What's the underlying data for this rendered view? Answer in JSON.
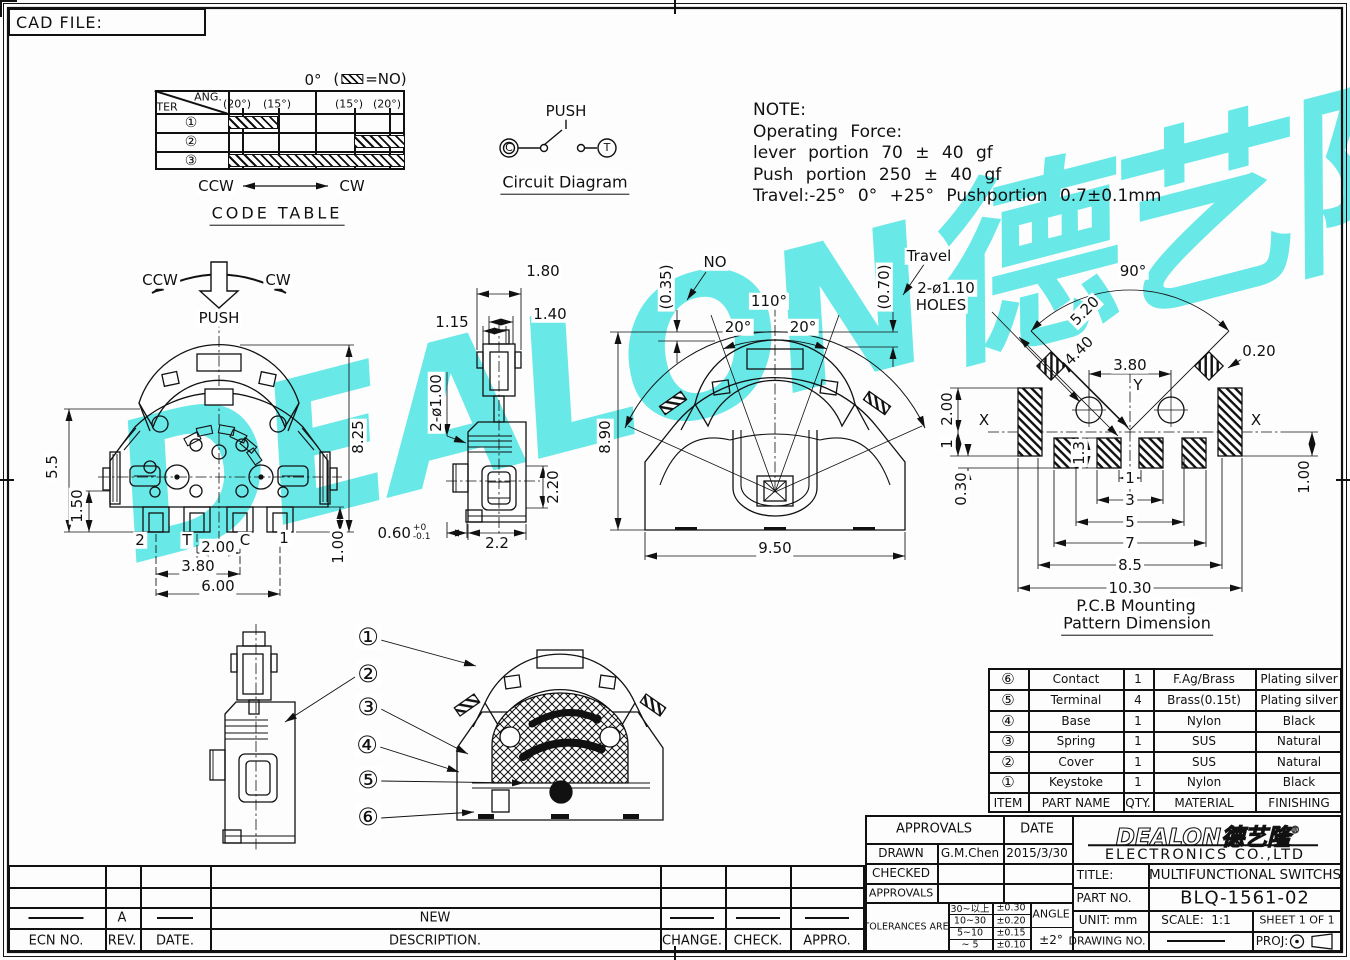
{
  "page": {
    "cad_file": "CAD FILE:"
  },
  "watermark": {
    "text": "DEALON德艺隆",
    "reg": "®",
    "color": "#45e4e4"
  },
  "code_table": {
    "title": "CODE TABLE",
    "ter": "TER",
    "ang": "ANG.",
    "zero": "0°",
    "legend_open": "(",
    "legend_close": "=NO)",
    "headers": [
      "(20°)",
      "(15°)",
      "(15°)",
      "(20°)"
    ],
    "rows": [
      "①",
      "②",
      "③"
    ],
    "ccw": "CCW",
    "cw": "CW"
  },
  "circuit": {
    "push": "PUSH",
    "c": "C",
    "t": "T",
    "title": "Circuit Diagram"
  },
  "note": {
    "l1": "NOTE:",
    "l2": "Operating Force:",
    "l3": "lever portion 70 ± 40 gf",
    "l4": "Push portion 250 ± 40 gf",
    "l5": "Travel:-25° 0° +25° Pushportion 0.7±0.1mm"
  },
  "front_view": {
    "ccw": "CCW",
    "cw": "CW",
    "push": "PUSH",
    "terminals": [
      "2",
      "T",
      "C",
      "1"
    ],
    "dims": {
      "d55": "5.5",
      "d150": "1.50",
      "d825": "8.25",
      "d100": "1.00",
      "d200": "2.00",
      "d380": "3.80",
      "d600": "6.00",
      "tol": "0.60",
      "tol_up": "+0",
      "tol_dn": "-0.1"
    }
  },
  "side_view": {
    "dims": {
      "d180": "1.80",
      "d115": "1.15",
      "d140": "1.40",
      "dphi": "2-ø1.00",
      "d220": "2.20",
      "d22": "2.2"
    }
  },
  "fan_view": {
    "no": "NO",
    "d035": "(0.35)",
    "d110": "110°",
    "d20l": "20°",
    "d20r": "20°",
    "travel": "Travel",
    "d070": "(0.70)",
    "d890": "8.90",
    "d950": "9.50"
  },
  "pcb_view": {
    "d90": "90°",
    "holes1": "2-ø1.10",
    "holes2": "HOLES",
    "d520": "5.20",
    "d440": "4.40",
    "d380": "3.80",
    "d020": "0.20",
    "d200": "2.00",
    "d1s": "1",
    "d030": "0.30",
    "d13": "1.3",
    "d100": "1.00",
    "x_left": "X",
    "x_right": "X",
    "y": "Y",
    "chain": [
      "1",
      "3",
      "5",
      "7",
      "8.5",
      "10.30"
    ],
    "caption1": "P.C.B Mounting",
    "caption2": "Pattern Dimension"
  },
  "exploded": {
    "balloons": [
      "①",
      "②",
      "③",
      "④",
      "⑤",
      "⑥"
    ]
  },
  "parts_table": {
    "headers": [
      "ITEM",
      "PART NAME",
      "QTY.",
      "MATERIAL",
      "FINISHING"
    ],
    "rows": [
      [
        "⑥",
        "Contact",
        "1",
        "F.Ag/Brass",
        "Plating silver"
      ],
      [
        "⑤",
        "Terminal",
        "4",
        "Brass(0.15t)",
        "Plating silver"
      ],
      [
        "④",
        "Base",
        "1",
        "Nylon",
        "Black"
      ],
      [
        "③",
        "Spring",
        "1",
        "SUS",
        "Natural"
      ],
      [
        "②",
        "Cover",
        "1",
        "SUS",
        "Natural"
      ],
      [
        "①",
        "Keystoke",
        "1",
        "Nylon",
        "Black"
      ]
    ]
  },
  "title_block": {
    "approvals": "APPROVALS",
    "date": "DATE",
    "drawn": "DRAWN",
    "drawn_by": "G.M.Chen",
    "drawn_date": "2015/3/30",
    "checked": "CHECKED",
    "approvals2": "APPROVALS",
    "tolerances": "TOLERANCES ARE",
    "tol": {
      "ranges": [
        "30~以上",
        "10~30",
        "5~10",
        "~ 5"
      ],
      "values": [
        "±0.30",
        "±0.20",
        "±0.15",
        "±0.10"
      ],
      "angle_label": "ANGLE",
      "angle_value": "±2°"
    },
    "company_logo": "DEALON德艺隆",
    "company_reg": "®",
    "company_name": "ELECTRONICS CO.,LTD",
    "title_label": "TITLE:",
    "title_value": "MULTIFUNCTIONAL SWITCHS",
    "part_label": "PART NO.",
    "part_value": "BLQ-1561-02",
    "unit_label": "UNIT:",
    "unit_value": "mm",
    "scale_label": "SCALE:",
    "scale_value": "1:1",
    "sheet_label": "SHEET",
    "sheet_value": "1 OF 1",
    "drawing_label": "DRAWING NO.",
    "proj_label": "PROJ:"
  },
  "revision": {
    "rev_value": "A",
    "description_value": "NEW",
    "ecn": "ECN NO.",
    "rev": "REV.",
    "date": "DATE.",
    "description": "DESCRIPTION.",
    "change": "CHANGE.",
    "check": "CHECK.",
    "appro": "APPRO."
  }
}
